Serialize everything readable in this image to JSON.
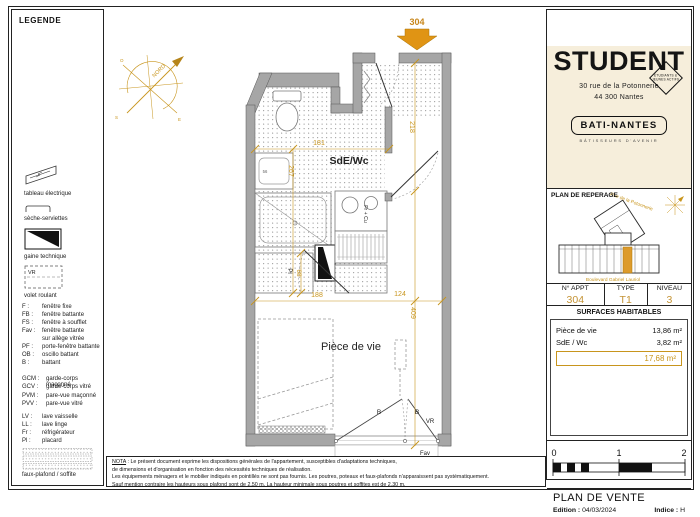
{
  "legend": {
    "title": "LEGENDE",
    "tableau": "tableau électrique",
    "seche": "sèche-serviettes",
    "gaine": "gaine technique",
    "vr_tag": "VR",
    "volet": "volet roulant",
    "faux": "faux-plafond / soffite",
    "abbr1": [
      {
        "k": "F :",
        "v": "fenêtre fixe"
      },
      {
        "k": "FB :",
        "v": "fenêtre battante"
      },
      {
        "k": "FS :",
        "v": "fenêtre à soufflet"
      },
      {
        "k": "Fav :",
        "v": "fenêtre battante"
      },
      {
        "k": "",
        "v": "sur allège vitrée"
      },
      {
        "k": "PF :",
        "v": "porte-fenêtre battante"
      },
      {
        "k": "OB :",
        "v": "oscillo battant"
      },
      {
        "k": "B :",
        "v": "battant"
      }
    ],
    "abbr2": [
      {
        "k": "GCM :",
        "v": "garde-corps maçonné"
      },
      {
        "k": "GCV :",
        "v": "garde-corps vitré"
      },
      {
        "k": "PVM :",
        "v": "pare-vue maçonné"
      },
      {
        "k": "PVV :",
        "v": "pare-vue vitré"
      }
    ],
    "abbr3": [
      {
        "k": "LV :",
        "v": "lave vaisselle"
      },
      {
        "k": "LL :",
        "v": "lave linge"
      },
      {
        "k": "Fr :",
        "v": "réfrigérateur"
      },
      {
        "k": "Pl :",
        "v": "placard"
      }
    ]
  },
  "plan": {
    "unit": "304",
    "room_bath": "SdE/Wc",
    "room_living": "Pièce de vie",
    "north": "NORD",
    "dims": {
      "bath_width": "181",
      "bath_height": "267",
      "hall_height": "218",
      "closet": "68",
      "living_width": "188",
      "living_right": "124",
      "living_height": "409",
      "sink": "56"
    },
    "labels": {
      "placard": "Pl",
      "kitchen": "Fr + Cu",
      "b_left": "B",
      "b_right": "B",
      "vr": "VR",
      "fav": "Fav"
    }
  },
  "brand": {
    "name": "STUDENT",
    "badge_line1": "ÉTUDIANTS &",
    "badge_line2": "JEUNES ACTIFS",
    "address1": "30 rue de la Potonnerie",
    "address2": "44 300 Nantes",
    "builder": "BATI-NANTES",
    "builder_tag": "BÂTISSEURS D'AVENIR"
  },
  "reperage": {
    "title": "PLAN DE REPERAGE",
    "street_top": "Rue de la Potonnerie",
    "street_bottom": "Boulevard Gabriel Lauriol"
  },
  "apt": {
    "h1": "N° APPT",
    "h2": "TYPE",
    "h3": "NIVEAU",
    "v1": "304",
    "v2": "T1",
    "v3": "3"
  },
  "surfaces": {
    "title": "SURFACES HABITABLES",
    "rows": [
      {
        "label": "Pièce de vie",
        "value": "13,86 m²"
      },
      {
        "label": "SdE / Wc",
        "value": "3,82 m²"
      }
    ],
    "total": "17,68 m²"
  },
  "scale": {
    "t0": "0",
    "t1": "1",
    "t2": "2"
  },
  "footer": {
    "title": "PLAN DE VENTE",
    "edition_label": "Edition :",
    "edition_value": "04/03/2024",
    "indice_label": "Indice :",
    "indice_value": "H"
  },
  "nota": {
    "label": "NOTA",
    "line1": " : Le présent document exprime les dispositions générales de l'appartement, susceptibles d'adaptations techniques,",
    "line2": "de dimensions et d'organisation en fonction des nécessités techniques de réalisation.",
    "line3": "Les équipements ménagers et le mobilier indiqués en pointillés ne sont pas fournis. Les poutres, poteaux et faux-plafonds n'apparaissent pas systématiquement.",
    "line4": "Sauf mention contraire les hauteurs sous plafond sont de 2,50 m. La hauteur minimale sous poutres et soffites est de 2,30 m."
  }
}
